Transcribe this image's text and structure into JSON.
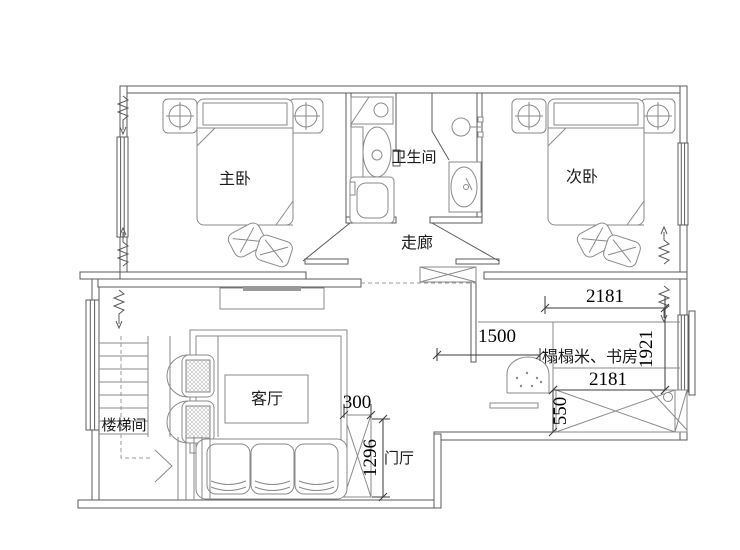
{
  "floorplan": {
    "rooms": {
      "master_bedroom": "主卧",
      "bathroom": "卫生间",
      "second_bedroom": "次卧",
      "corridor": "走廊",
      "living_room": "客厅",
      "stairwell": "楼梯间",
      "tatami_study": "榻榻米、书房",
      "entrance_hall": "门厅"
    },
    "dimensions_mm": {
      "study_top_width": "2181",
      "study_right_depth": "1921",
      "study_left_width": "1500",
      "study_bottom_width": "2181",
      "wardrobe_depth": "550",
      "entry_cabinet_width": "300",
      "entry_hall_depth": "1296"
    },
    "colors": {
      "wall_line": "#5b5b5b",
      "furniture_line": "#8a8a8a",
      "dimension_line": "#3a3a3a",
      "text": "#1a1a1a",
      "tv_bar": "#999999",
      "background": "#ffffff"
    }
  }
}
